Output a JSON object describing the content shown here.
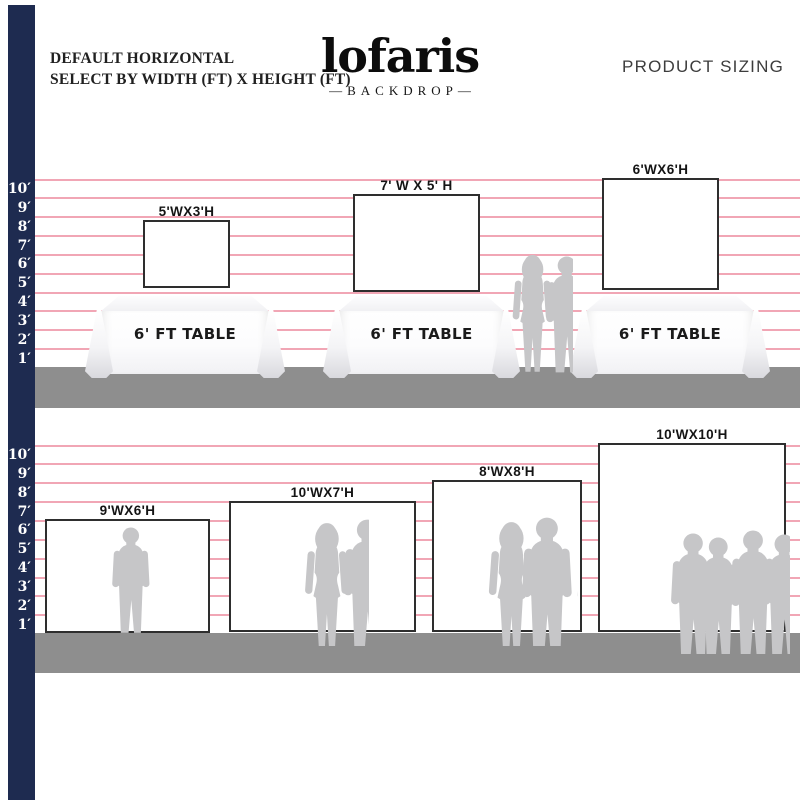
{
  "header": {
    "subtitle_line1": "DEFAULT HORIZONTAL",
    "subtitle_line2": "SELECT BY WIDTH (FT) X HEIGHT (FT)",
    "brand": "lofaris",
    "brand_sub": "—BACKDROP—",
    "right_title": "PRODUCT SIZING"
  },
  "ruler": {
    "labels": [
      "10′",
      "9′",
      "8′",
      "7′",
      "6′",
      "5′",
      "4′",
      "3′",
      "2′",
      "1′"
    ]
  },
  "top_section": {
    "backdrops": [
      {
        "label": "5'WX3'H"
      },
      {
        "label": "7' W X 5' H"
      },
      {
        "label": "6'WX6'H"
      }
    ],
    "tables": [
      {
        "label": "6' FT TABLE"
      },
      {
        "label": "6' FT TABLE"
      },
      {
        "label": "6' FT TABLE"
      }
    ],
    "people_between_tables": 2
  },
  "bottom_section": {
    "backdrops": [
      {
        "label": "9'WX6'H",
        "people": 1
      },
      {
        "label": "10'WX7'H",
        "people": 2
      },
      {
        "label": "8'WX8'H",
        "people": 3
      },
      {
        "label": "10'WX10'H",
        "people": 6
      }
    ]
  },
  "colors": {
    "ruler_bar": "#1e2b50",
    "grid_line": "#ee96a8",
    "floor": "#8e8e8e",
    "silhouette": "#c6c6c8"
  }
}
